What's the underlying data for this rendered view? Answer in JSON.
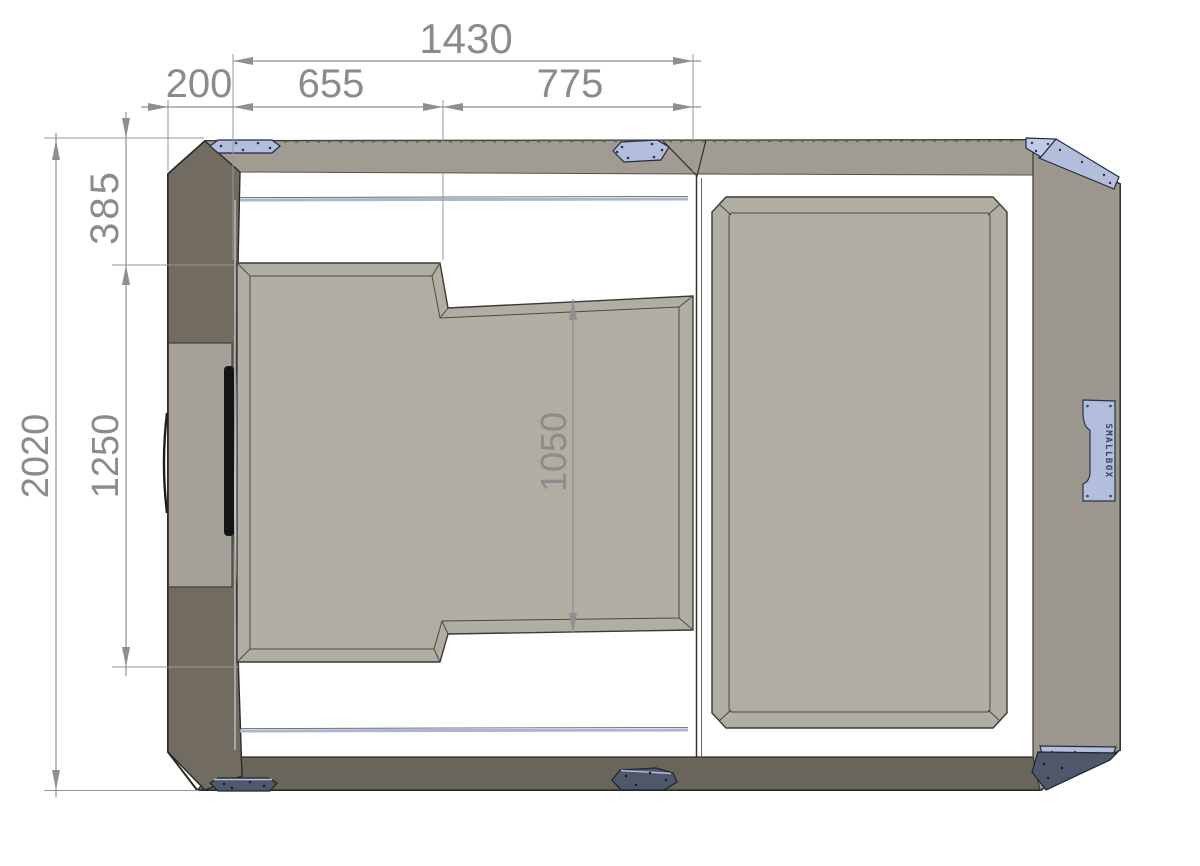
{
  "dimensions": {
    "overall_width": "1430",
    "wall_offset": "200",
    "segment_left": "655",
    "segment_right": "775",
    "top_inset": "385",
    "opening_length": "1250",
    "overall_length": "2020",
    "inner_length": "1050"
  },
  "logo": {
    "text": "SMALLBOX"
  },
  "colors": {
    "background": "#ffffff",
    "body_face": "#a9a59b",
    "top_band": "#a09c93",
    "side_wall_dark": "#716b60",
    "side_door": "#a5a199",
    "bottom_band": "#6a655b",
    "right_wall": "#9b978d",
    "panel_face": "#b0ada3",
    "bracket_light": "#b3bedd",
    "bracket_light_top": "#c1cbe6",
    "bracket_dark": "#4f586b",
    "seam_blue": "#a9b5d3",
    "handle_black": "#151515",
    "dimension_gray": "#8b8b8b",
    "outline_dark": "#2b2a26"
  }
}
